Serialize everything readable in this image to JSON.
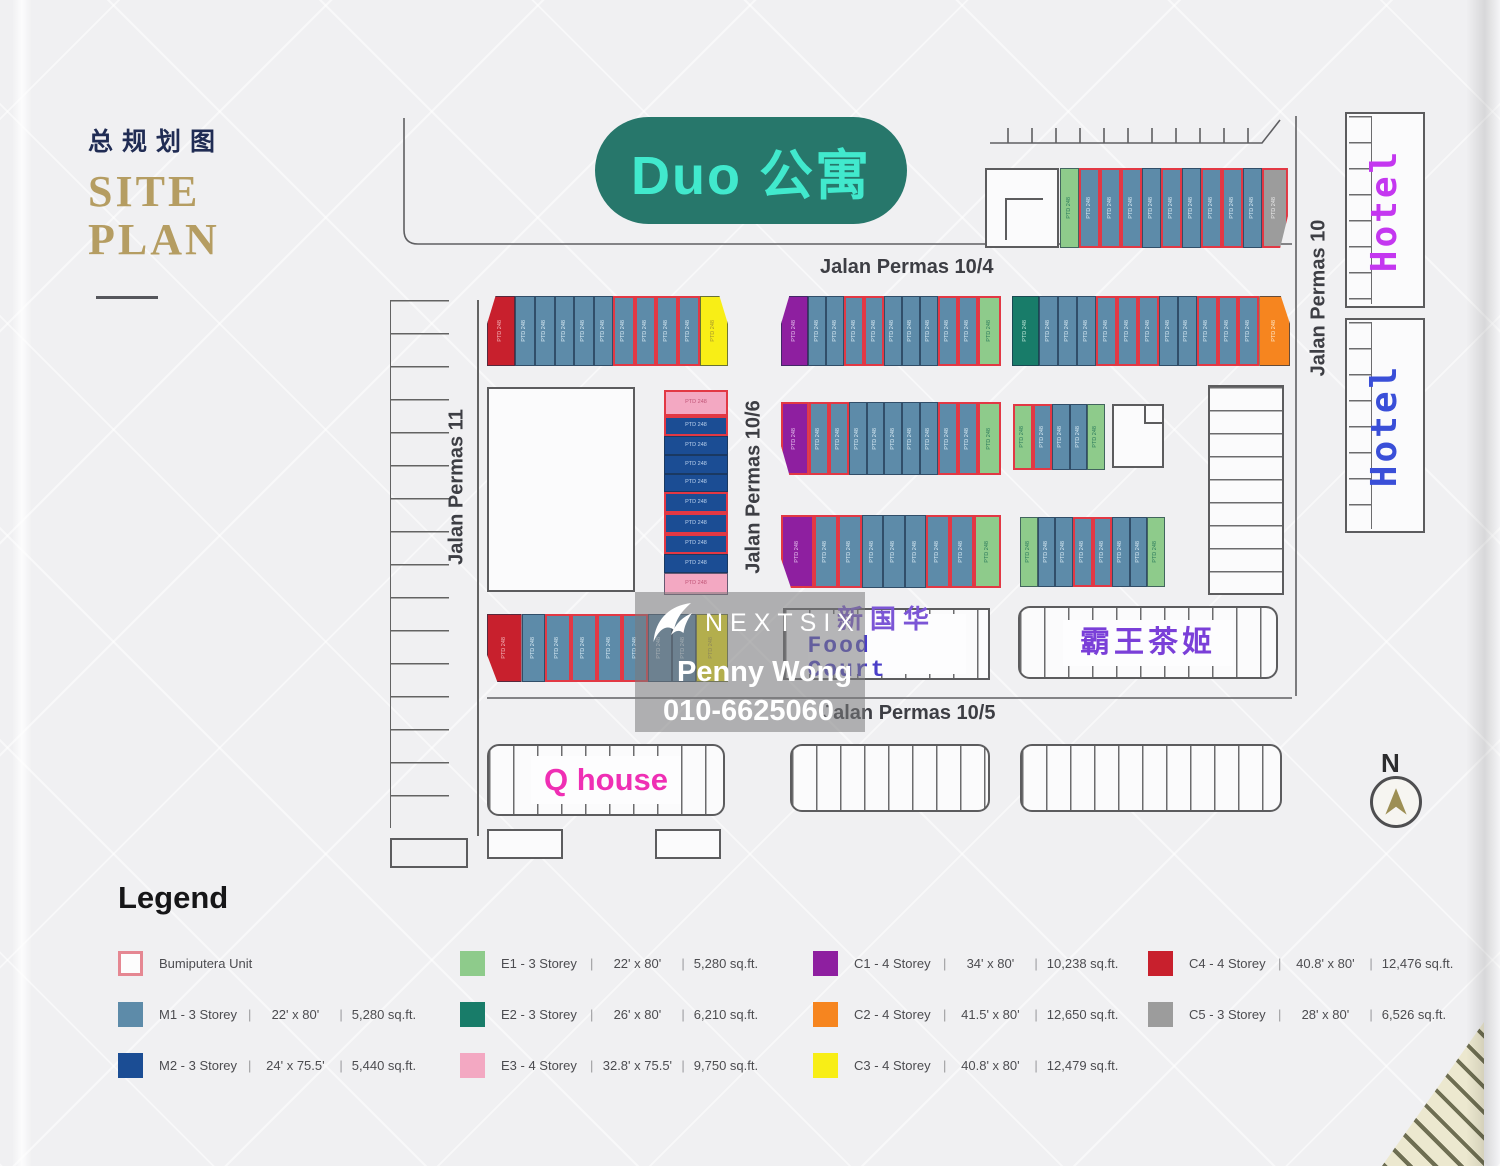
{
  "title": {
    "cn": "总规划图",
    "en_line1": "SITE",
    "en_line2": "PLAN"
  },
  "project_badge": {
    "text": "Duo 公寓"
  },
  "roads": {
    "r104": "Jalan Permas 10/4",
    "r105": "Jalan Permas 10/5",
    "r106": "Jalan Permas 10/6",
    "r11": "Jalan Permas 11",
    "r10": "Jalan Permas 10"
  },
  "places": {
    "hotel_top": "Hotel",
    "hotel_bottom": "Hotel",
    "food_court_cn": "新国华",
    "food_court_en": "Food Court",
    "tea_shop": "霸王茶姬",
    "q_house": "Q house"
  },
  "compass": {
    "label": "N"
  },
  "watermark": {
    "brand": "NEXTSIX",
    "agent": "Penny Wong",
    "phone": "010-6625060"
  },
  "lot_label": "PTD 248",
  "lot_types": {
    "M1": {
      "color": "#5d8ba9",
      "label_color": "#d9ebf5"
    },
    "M2": {
      "color": "#1b4d94",
      "label_color": "#bcd2ee"
    },
    "E1": {
      "color": "#8ecb8b",
      "label_color": "#2c7a5c"
    },
    "E2": {
      "color": "#187c69",
      "label_color": "#bfe8d9"
    },
    "E3": {
      "color": "#f3a8c2",
      "label_color": "#c05577"
    },
    "C1": {
      "color": "#8e1fa0",
      "label_color": "#e6c2ee"
    },
    "C2": {
      "color": "#f6851f",
      "label_color": "#ffeacb"
    },
    "C3": {
      "color": "#f8ee16",
      "label_color": "#a4952e"
    },
    "C4": {
      "color": "#c8202d",
      "label_color": "#f4b9bd"
    },
    "C5": {
      "color": "#9c9c9c",
      "label_color": "#ebebeb"
    }
  },
  "blocks": [
    {
      "name": "north-east-row",
      "x": 1060,
      "y": 168,
      "w": 228,
      "h": 80,
      "orient": "h",
      "bevel_last": "br",
      "ends": [
        1,
        1.3
      ],
      "lots": [
        "E1",
        "M1b",
        "M1b",
        "M1b",
        "M1",
        "M1b",
        "M1",
        "M1b",
        "M1b",
        "M1",
        "C5b"
      ]
    },
    {
      "name": "row-10-4-west",
      "x": 487,
      "y": 296,
      "w": 241,
      "h": 70,
      "orient": "h",
      "bevel_first": "tl",
      "bevel_last": "tr",
      "ends": [
        1.5,
        1.5
      ],
      "lots": [
        "C4",
        "M1",
        "M1",
        "M1",
        "M1",
        "M1",
        "M1b",
        "M1b",
        "M1b",
        "M1b",
        "C3"
      ]
    },
    {
      "name": "row-10-4-mid",
      "x": 781,
      "y": 296,
      "w": 220,
      "h": 70,
      "orient": "h",
      "bevel_first": "tl",
      "ends": [
        1.6,
        1.2
      ],
      "lots": [
        "C1",
        "M1",
        "M1",
        "M1b",
        "M1b",
        "M1",
        "M1",
        "M1",
        "M1b",
        "M1b",
        "E1b"
      ]
    },
    {
      "name": "row-10-4-east",
      "x": 1012,
      "y": 296,
      "w": 278,
      "h": 70,
      "orient": "h",
      "bevel_last": "tr",
      "ends": [
        1.5,
        1.7
      ],
      "lots": [
        "E2",
        "M1",
        "M1",
        "M1",
        "M1b",
        "M1b",
        "M1b",
        "M1",
        "M1",
        "M1b",
        "M1b",
        "M1b",
        "C2"
      ]
    },
    {
      "name": "col-10-6",
      "x": 664,
      "y": 390,
      "w": 64,
      "h": 205,
      "orient": "v",
      "ends": [
        1.3,
        1.2
      ],
      "lots": [
        "E3b",
        "M2b",
        "M2",
        "M2",
        "M2",
        "M2b",
        "M2b",
        "M2b",
        "M2",
        "E3"
      ]
    },
    {
      "name": "row-mid-west",
      "x": 781,
      "y": 402,
      "w": 220,
      "h": 73,
      "orient": "h",
      "bevel_first": "bl",
      "ends": [
        1.5,
        1.2
      ],
      "lots": [
        "C1b",
        "M1b",
        "M1b",
        "M1",
        "M1",
        "M1",
        "M1",
        "M1",
        "M1b",
        "M1b",
        "E1b"
      ]
    },
    {
      "name": "row-mid-small",
      "x": 1013,
      "y": 404,
      "w": 92,
      "h": 66,
      "orient": "h",
      "lots": [
        "E1b",
        "M1b",
        "M1",
        "M1",
        "E1"
      ]
    },
    {
      "name": "row-lower-west",
      "x": 781,
      "y": 515,
      "w": 220,
      "h": 73,
      "orient": "h",
      "bevel_first": "bl",
      "ends": [
        1.5,
        1.2
      ],
      "lots": [
        "C1b",
        "M1b",
        "M1b",
        "M1",
        "M1",
        "M1",
        "M1b",
        "M1b",
        "E1b"
      ]
    },
    {
      "name": "row-lower-east",
      "x": 1020,
      "y": 517,
      "w": 145,
      "h": 70,
      "orient": "h",
      "lots": [
        "E1",
        "M1",
        "M1",
        "M1b",
        "M1b",
        "M1",
        "M1",
        "E1"
      ]
    },
    {
      "name": "row-10-5",
      "x": 487,
      "y": 614,
      "w": 241,
      "h": 68,
      "orient": "h",
      "bevel_first": "bl",
      "ends": [
        1.5,
        1.4
      ],
      "lots": [
        "C4",
        "M1",
        "M1b",
        "M1b",
        "M1b",
        "M1b",
        "M1",
        "M1",
        "C3"
      ]
    }
  ],
  "legend": {
    "heading": "Legend",
    "items": [
      {
        "code": "BUMI",
        "col": 1,
        "label": "Bumiputera Unit",
        "swatch": "outline"
      },
      {
        "code": "M1",
        "col": 1,
        "label": "M1 - 3 Storey",
        "size": "22' x 80'",
        "area": "5,280 sq.ft."
      },
      {
        "code": "M2",
        "col": 1,
        "label": "M2 - 3 Storey",
        "size": "24' x 75.5'",
        "area": "5,440 sq.ft."
      },
      {
        "code": "E1",
        "col": 2,
        "label": "E1 - 3 Storey",
        "size": "22' x 80'",
        "area": "5,280 sq.ft."
      },
      {
        "code": "E2",
        "col": 2,
        "label": "E2 - 3 Storey",
        "size": "26' x 80'",
        "area": "6,210 sq.ft."
      },
      {
        "code": "E3",
        "col": 2,
        "label": "E3 - 4 Storey",
        "size": "32.8' x 75.5'",
        "area": "9,750 sq.ft."
      },
      {
        "code": "C1",
        "col": 3,
        "label": "C1 - 4 Storey",
        "size": "34' x 80'",
        "area": "10,238 sq.ft."
      },
      {
        "code": "C2",
        "col": 3,
        "label": "C2 - 4 Storey",
        "size": "41.5' x 80'",
        "area": "12,650 sq.ft."
      },
      {
        "code": "C3",
        "col": 3,
        "label": "C3 - 4 Storey",
        "size": "40.8' x 80'",
        "area": "12,479 sq.ft."
      },
      {
        "code": "C4",
        "col": 4,
        "label": "C4 - 4 Storey",
        "size": "40.8' x 80'",
        "area": "12,476 sq.ft."
      },
      {
        "code": "C5",
        "col": 4,
        "label": "C5 - 3 Storey",
        "size": "28' x 80'",
        "area": "6,526 sq.ft."
      }
    ]
  }
}
